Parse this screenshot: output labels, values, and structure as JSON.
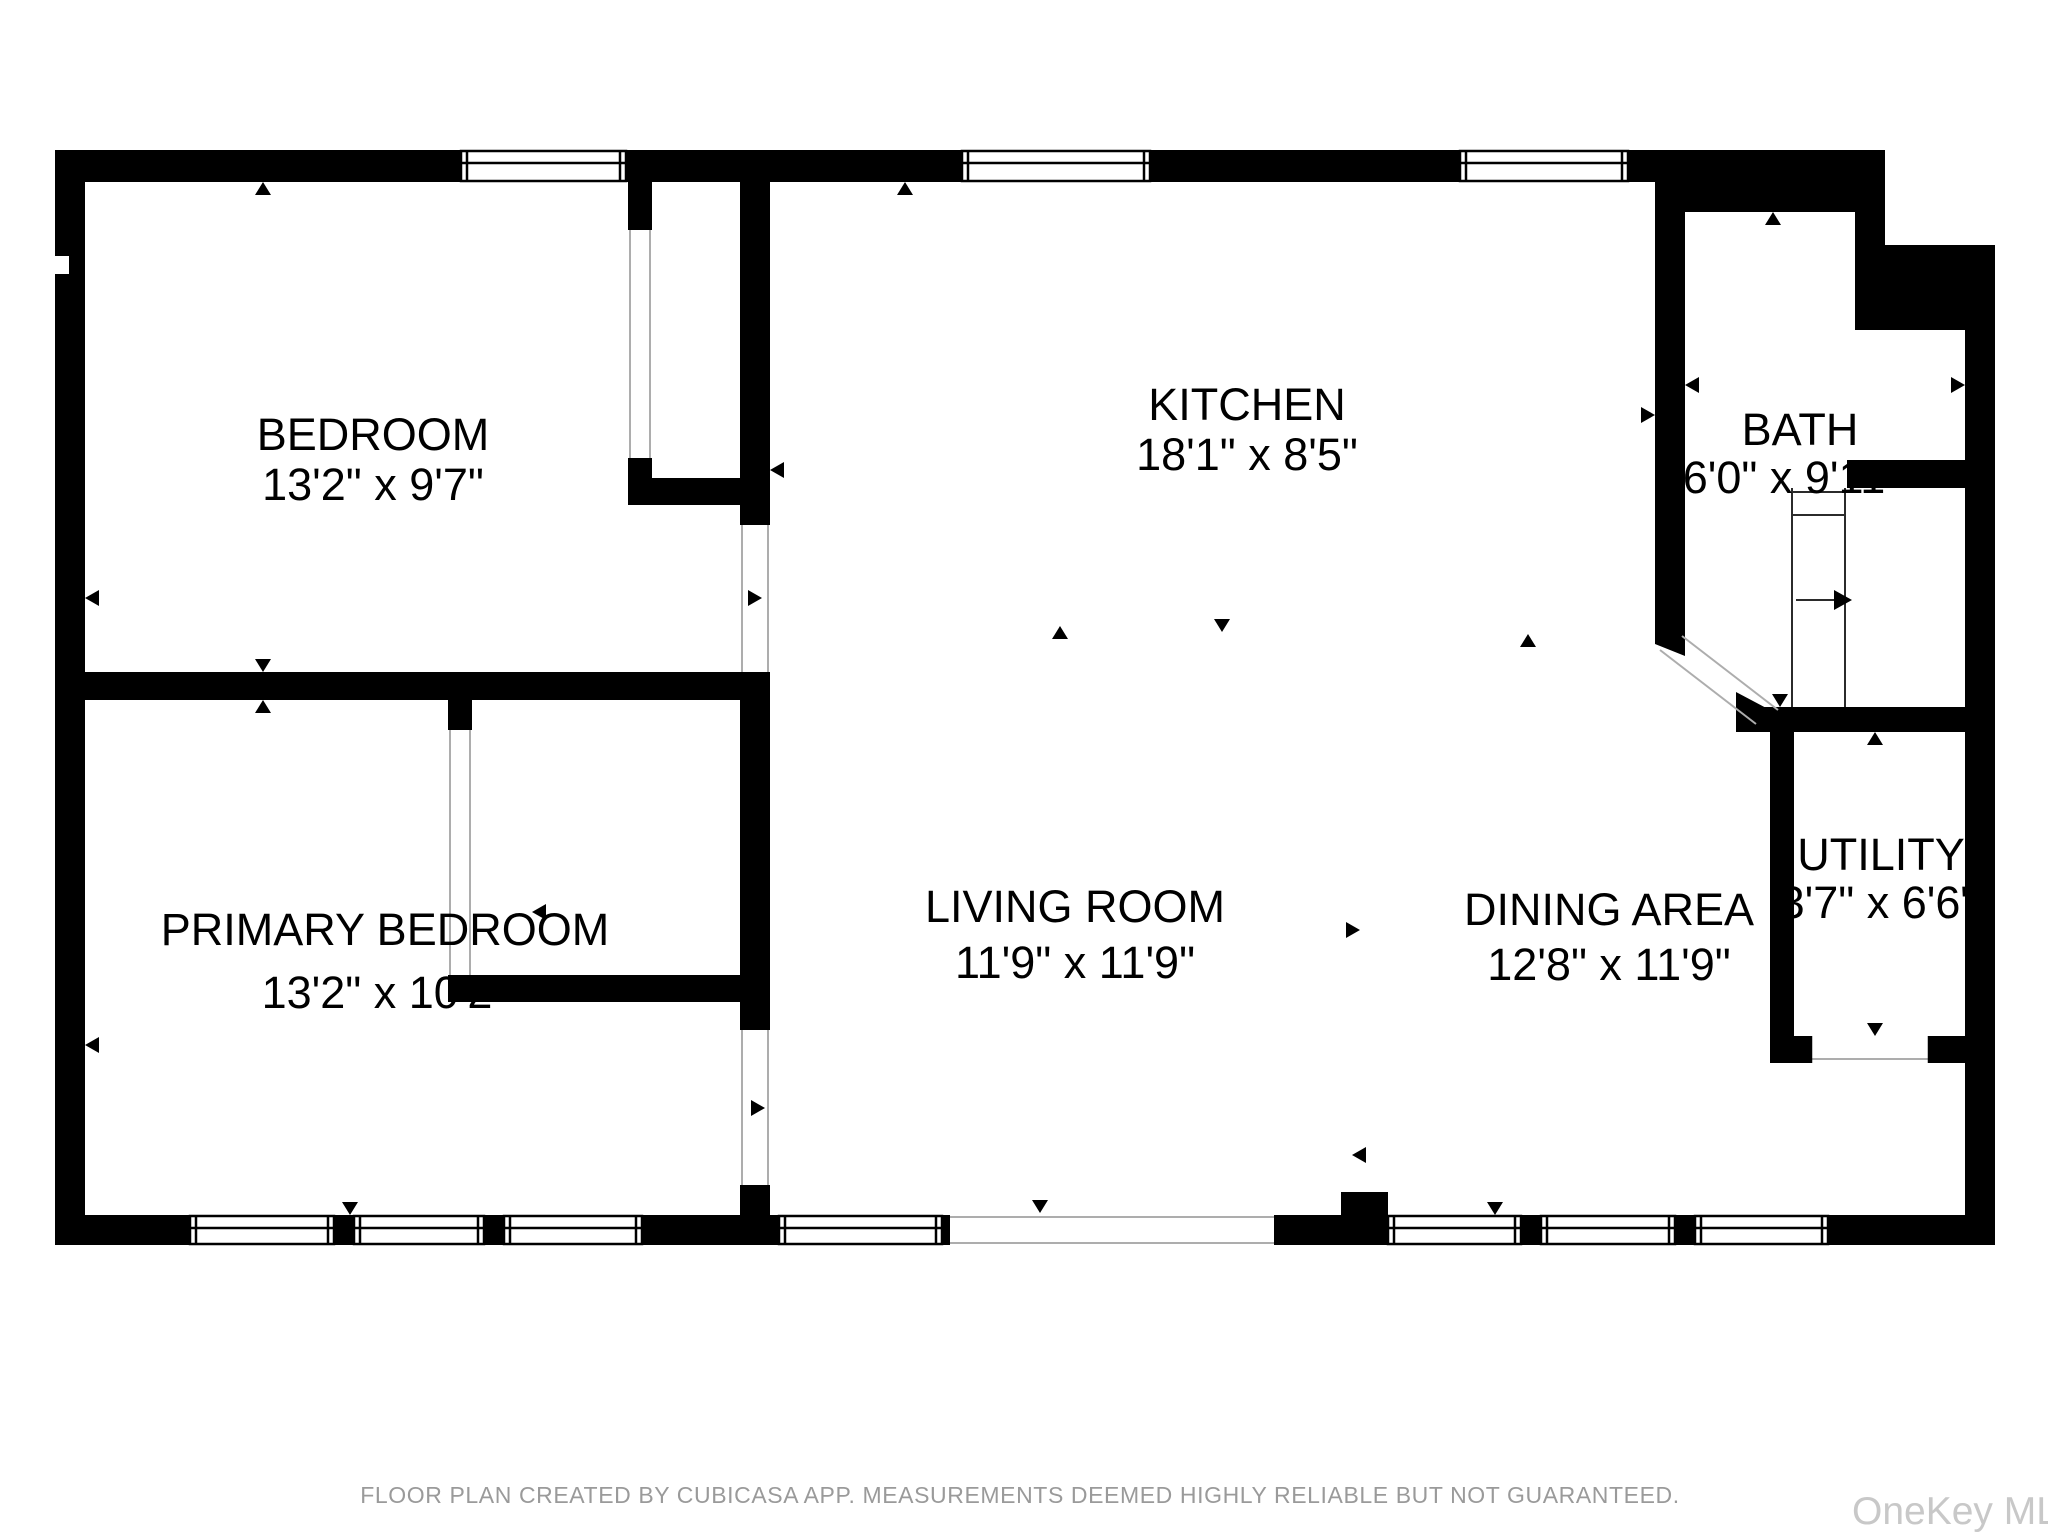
{
  "rooms": {
    "bedroom": {
      "name": "BEDROOM",
      "dims": "13'2\" x 9'7\""
    },
    "kitchen": {
      "name": "KITCHEN",
      "dims": "18'1\" x 8'5\""
    },
    "bath": {
      "name": "BATH",
      "dims": "6'0\" x 9'11\""
    },
    "primary_bedroom": {
      "name": "PRIMARY BEDROOM",
      "dims": "13'2\" x 10'2\""
    },
    "living_room": {
      "name": "LIVING ROOM",
      "dims": "11'9\" x 11'9\""
    },
    "dining_area": {
      "name": "DINING AREA",
      "dims": "12'8\" x 11'9\""
    },
    "utility": {
      "name": "UTILITY",
      "dims": "3'7\" x 6'6\""
    }
  },
  "footer": {
    "disclaimer": "FLOOR PLAN CREATED BY CUBICASA APP. MEASUREMENTS DEEMED HIGHLY RELIABLE BUT NOT GUARANTEED."
  },
  "watermark": "OneKey MLS",
  "colors": {
    "wall": "#000000",
    "background": "#ffffff",
    "door_swing_line": "#adadad",
    "disclaimer_text": "#9a9a9a",
    "watermark_text": "#c8c8c8"
  }
}
